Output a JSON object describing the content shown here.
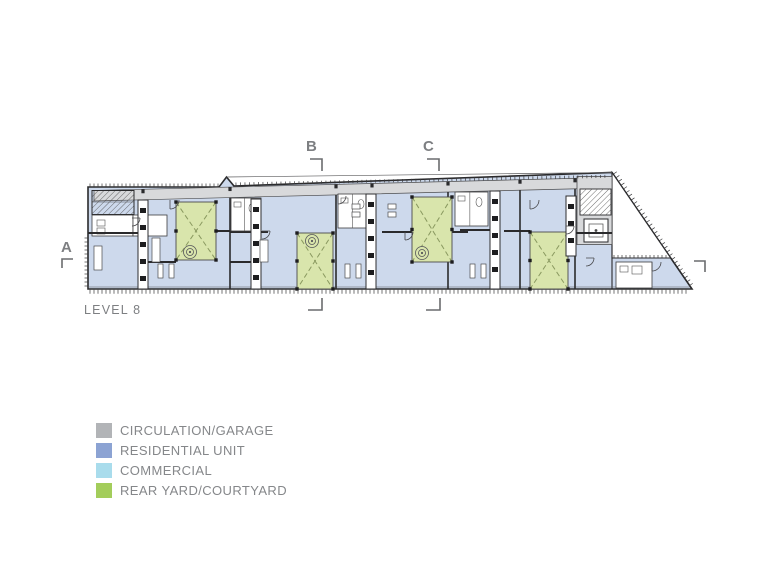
{
  "page": {
    "background": "#ffffff"
  },
  "plan": {
    "level_label": "LEVEL 8",
    "section_a": "A",
    "section_b": "B",
    "section_c": "C"
  },
  "legend": {
    "items": [
      {
        "label": "CIRCULATION/GARAGE",
        "color": "#b2b4b7"
      },
      {
        "label": "RESIDENTIAL UNIT",
        "color": "#8ca3d3"
      },
      {
        "label": "COMMERCIAL",
        "color": "#a9dcec"
      },
      {
        "label": "REAR YARD/COURTYARD",
        "color": "#a3cd5b"
      }
    ]
  },
  "colors": {
    "paper": "#ffffff",
    "ink": "#2a2a2c",
    "line-mid": "#58595b",
    "text-gray": "#7d7f82",
    "legend-text": "#85878a",
    "bracket": "#6a6c6e",
    "residential": "#cdd9ec",
    "courtyard": "#d9e5ac",
    "courtyard-line": "#8a9960",
    "circulation": "#d8d9db"
  }
}
